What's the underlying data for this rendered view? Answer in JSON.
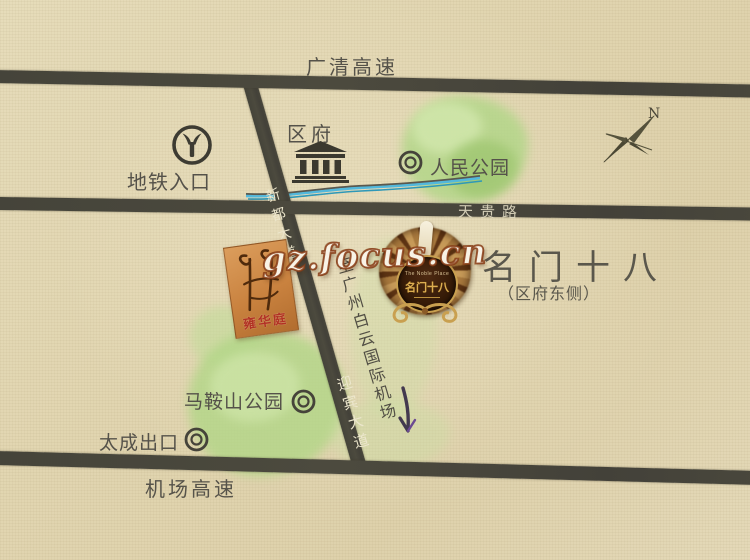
{
  "watermark": {
    "text": "gz.focus.cn"
  },
  "compass": {
    "north_label": "N"
  },
  "roads": {
    "guanqing_expressway": "广清高速",
    "tiangui_road": "天贵路",
    "airport_expressway": "机场高速",
    "xindu_avenue": "新都大道",
    "yingbin_avenue": "迎宾大道"
  },
  "landmarks": {
    "metro_entrance": "地铁入口",
    "district_government": "区府",
    "peoples_park": "人民公园",
    "maanshan_park": "马鞍山公园",
    "taicheng_exit": "太成出口"
  },
  "project": {
    "name": "名门十八",
    "location_note": "（区府东侧）",
    "crest_english": "The Noble Place",
    "crest_chinese": "名门十八"
  },
  "adjacent_project_logo": {
    "text": "雍华庭"
  },
  "airport_direction": {
    "text": "至广州白云国际机场"
  },
  "colors": {
    "paper": "#e2d6b2",
    "road": "#47453a",
    "park_green": "#b2d687",
    "river_blue": "#4fb8dc",
    "ink": "#55524a",
    "watermark_outline": "#8a3e18",
    "crest_gold": "#c9a050",
    "card_orange": "#c9823f",
    "seal_red": "#b23224"
  }
}
